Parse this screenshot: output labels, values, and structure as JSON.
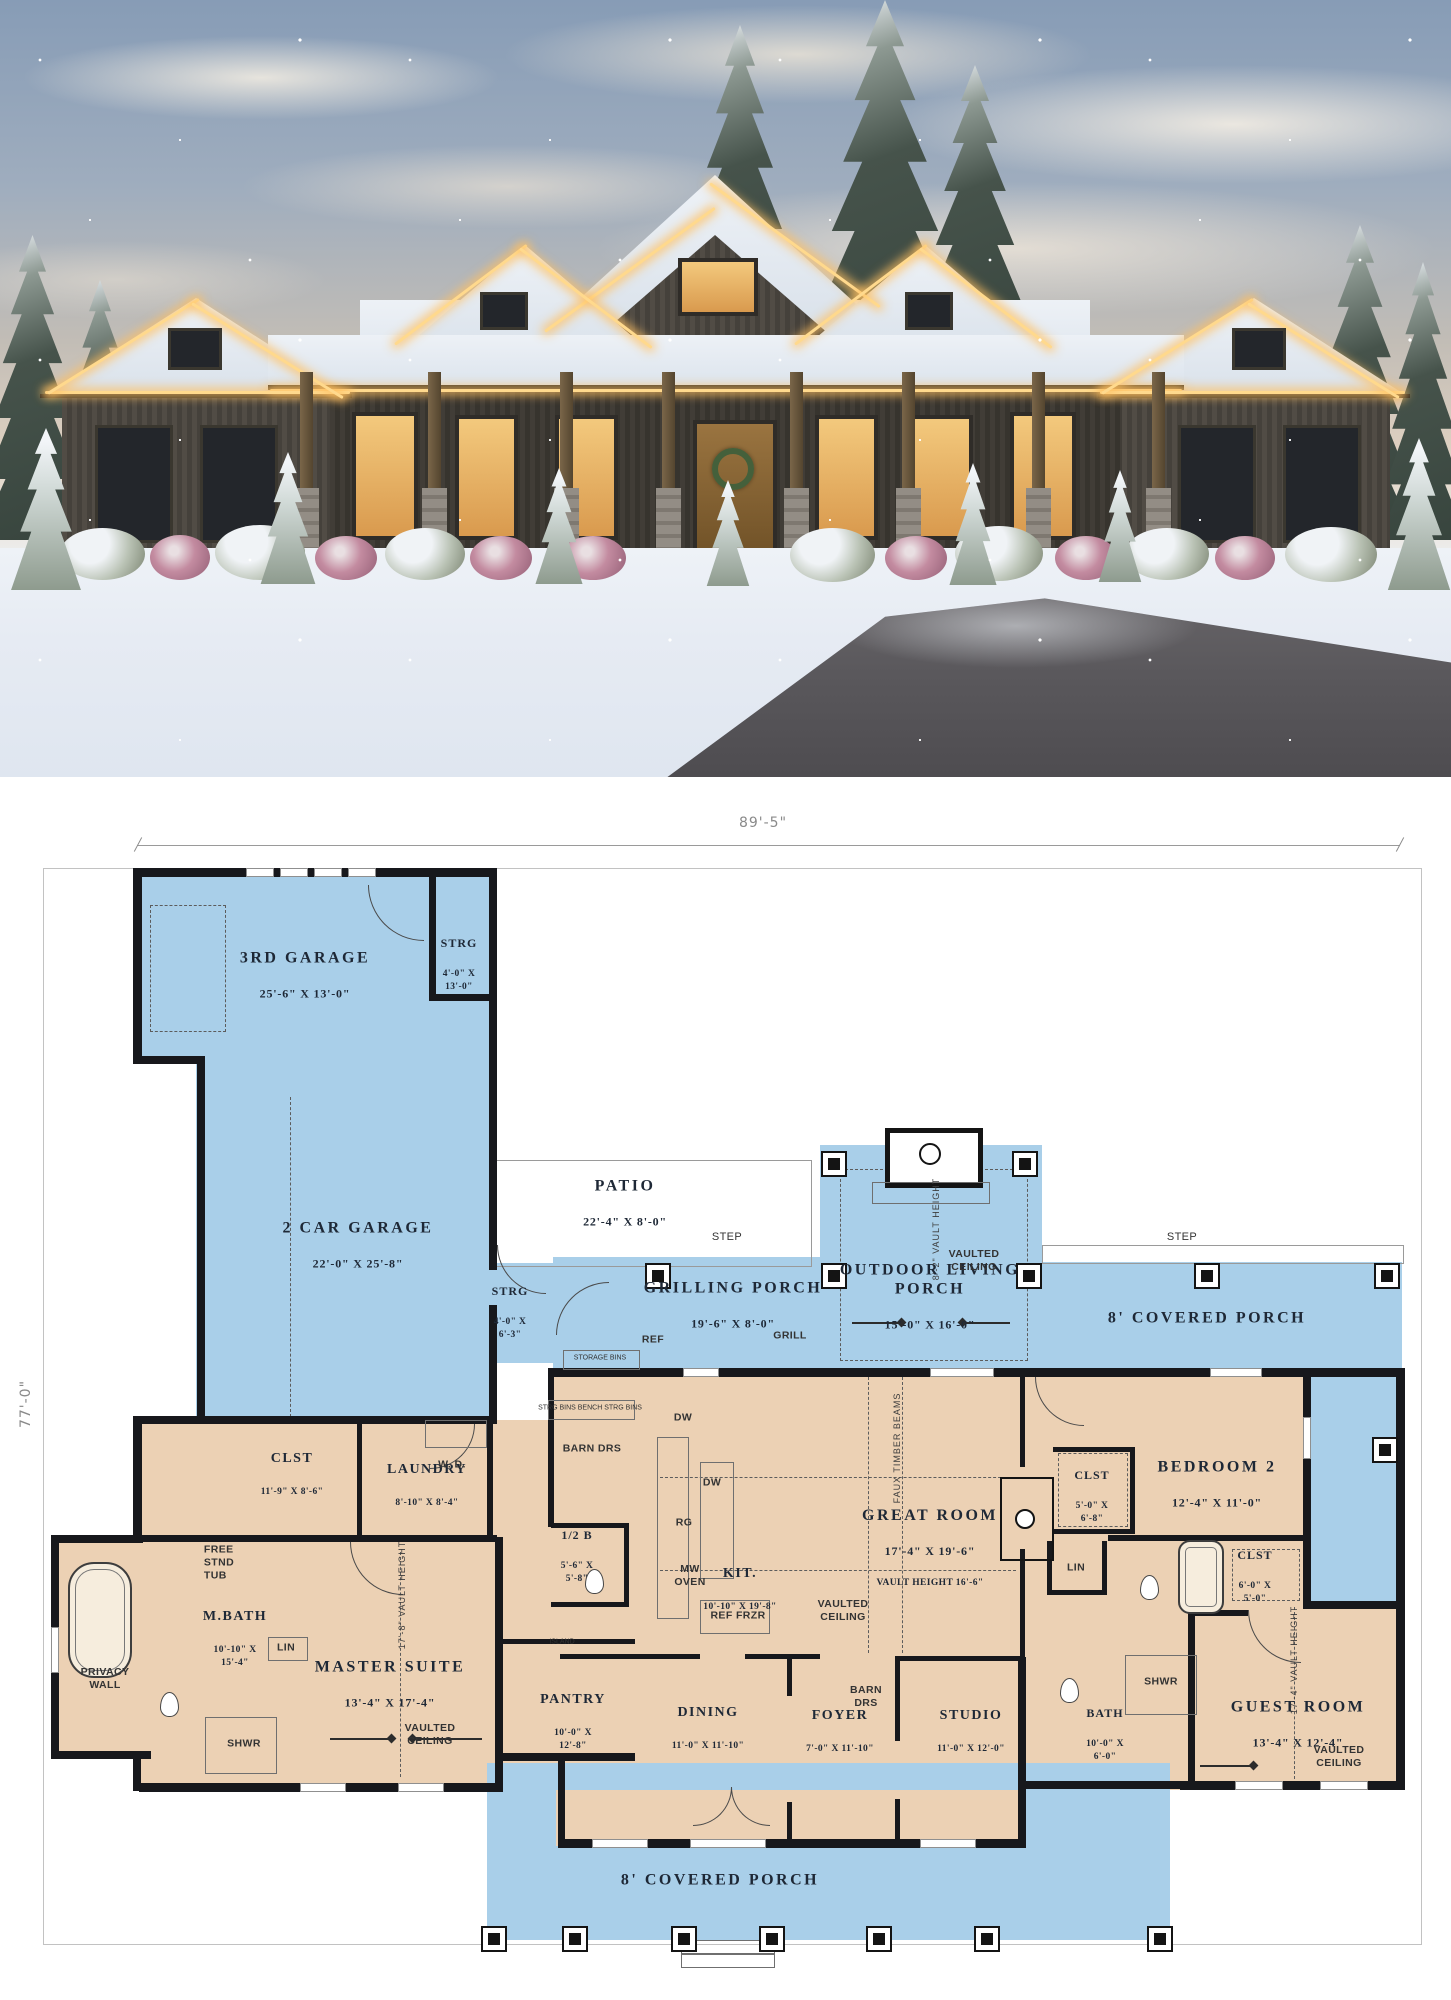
{
  "colors": {
    "plan_blue": "#a9cfe9",
    "plan_tan": "#ecd1b4",
    "wall": "#17181c",
    "label_ink": "#1e2836",
    "lot_line": "#c2c2c2"
  },
  "dimensions": {
    "width": "89'-5\"",
    "depth": "77'-0\""
  },
  "rooms": {
    "garage3": {
      "name": "3RD GARAGE",
      "dims": "25'-6\" X 13'-0\""
    },
    "strg1": {
      "name": "STRG",
      "dims": "4'-0\" X\n13'-0\""
    },
    "garage2": {
      "name": "2 CAR GARAGE",
      "dims": "22'-0\" X 25'-8\""
    },
    "patio": {
      "name": "PATIO",
      "dims": "22'-4\" X 8'-0\""
    },
    "grilling": {
      "name": "GRILLING PORCH",
      "dims": "19'-6\" X 8'-0\""
    },
    "strg2": {
      "name": "STRG",
      "dims": "4'-0\" X\n6'-3\""
    },
    "outdoor": {
      "name": "OUTDOOR LIVING\nPORCH",
      "dims": "15'-0\" X 16'-0\"",
      "ceiling": "VAULTED\nCEILING",
      "vault": "8'-2\" VAULT HEIGHT"
    },
    "porch_right": {
      "name": "8' COVERED PORCH"
    },
    "porch_bottom": {
      "name": "8' COVERED PORCH"
    },
    "clst_master": {
      "name": "CLST",
      "dims": "11'-9\" X 8'-6\""
    },
    "laundry": {
      "name": "LAUNDRY",
      "dims": "8'-10\" X 8'-4\""
    },
    "halfbath": {
      "name": "1/2 B",
      "dims": "5'-6\" X\n5'-8\""
    },
    "mbath": {
      "name": "M.BATH",
      "dims": "10'-10\" X\n15'-4\""
    },
    "master": {
      "name": "MASTER SUITE",
      "dims": "13'-4\" X 17'-4\"",
      "ceiling": "VAULTED\nCEILING",
      "vault": "17'-8\" VAULT HEIGHT"
    },
    "kitchen": {
      "name": "KIT.",
      "dims": "10'-10\" X 19'-8\""
    },
    "pantry": {
      "name": "PANTRY",
      "dims": "10'-0\" X\n12'-8\""
    },
    "dining": {
      "name": "DINING",
      "dims": "11'-0\" X 11'-10\""
    },
    "foyer": {
      "name": "FOYER",
      "dims": "7'-0\" X 11'-10\""
    },
    "studio": {
      "name": "STUDIO",
      "dims": "11'-0\" X 12'-0\""
    },
    "great": {
      "name": "GREAT ROOM",
      "dims": "17'-4\" X 19'-6\"",
      "vault_line": "VAULT HEIGHT 16'-6\"",
      "ceiling": "VAULTED\nCEILING",
      "beams": "FAUX TIMBER BEAMS"
    },
    "bedroom2": {
      "name": "BEDROOM 2",
      "dims": "12'-4\" X 11'-0\""
    },
    "clst_b2": {
      "name": "CLST",
      "dims": "5'-0\" X\n6'-8\""
    },
    "clst_guest": {
      "name": "CLST",
      "dims": "6'-0\" X\n5'-0\""
    },
    "bath2": {
      "name": "BATH",
      "dims": "10'-0\" X\n6'-0\""
    },
    "guest": {
      "name": "GUEST ROOM",
      "dims": "13'-4\" X 12'-4\"",
      "ceiling": "VAULTED\nCEILING",
      "vault": "17'-4\" VAULT HEIGHT"
    }
  },
  "fixtures": {
    "step1": "STEP",
    "step2": "STEP",
    "ref": "REF",
    "grill": "GRILL",
    "storage_bins": "STORAGE BINS",
    "bins_row": "STRG BINS   BENCH   STRG BINS",
    "dw1": "DW",
    "dw2": "DW",
    "rg": "RG",
    "mw": "MW\nOVEN",
    "ref_frzr": "REF   FRZR",
    "island": "ISLAND",
    "barn1": "BARN DRS",
    "barn2": "BARN\nDRS",
    "wd": "W.   D.",
    "free_tub": "FREE\nSTND\nTUB",
    "lin1": "LIN",
    "lin2": "LIN",
    "shwr1": "SHWR",
    "shwr2": "SHWR",
    "privacy": "PRIVACY\nWALL"
  }
}
